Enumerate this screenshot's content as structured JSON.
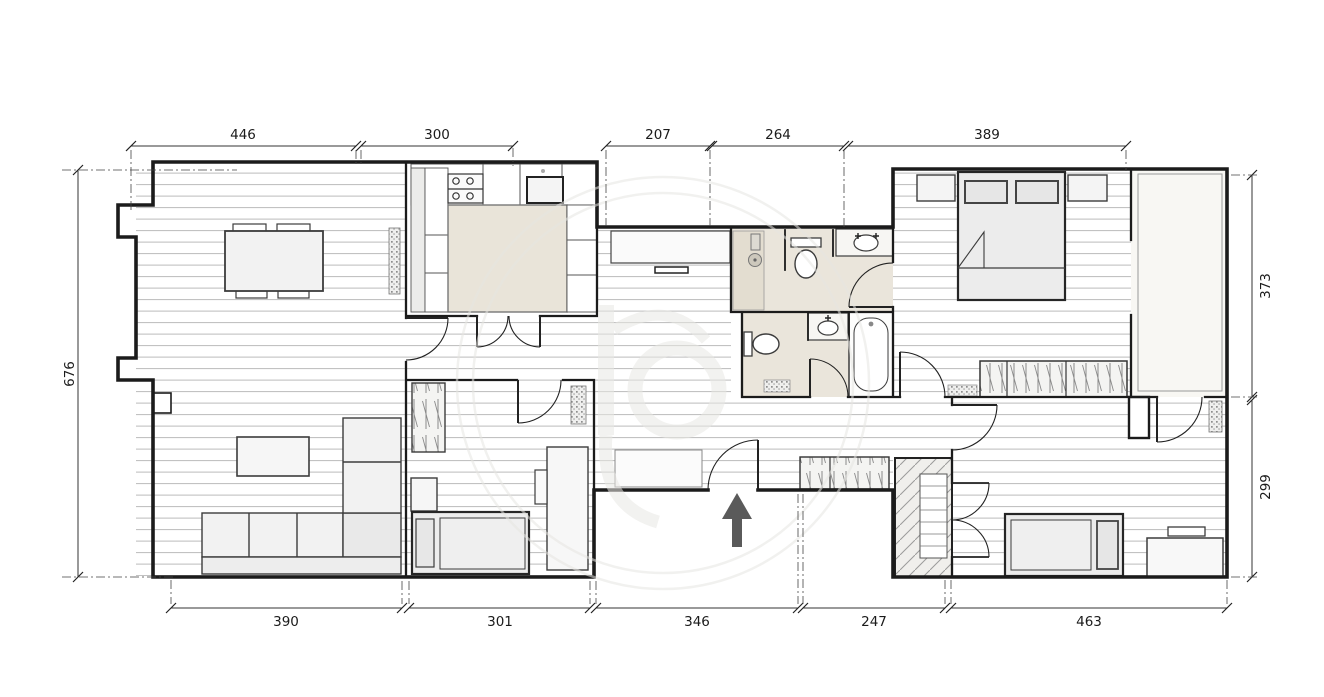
{
  "plan": {
    "type": "apartment-floor-plan",
    "dimensions": {
      "top": [
        "446",
        "300",
        "207",
        "264",
        "389"
      ],
      "bottom": [
        "390",
        "301",
        "346",
        "247",
        "463"
      ],
      "left": [
        "676"
      ],
      "right": [
        "373",
        "299"
      ]
    },
    "entrance": {
      "marker": "arrow-up"
    },
    "colors": {
      "wall": "#1b1b1b",
      "bathroom_floor": "#eae5db",
      "kitchen_island": "#e9e4d9",
      "terrace_floor": "#f8f7f3",
      "furniture_fill": "#f2f2f2",
      "arrow": "#5a5a5a",
      "watermark": "#e7e6e2"
    }
  }
}
